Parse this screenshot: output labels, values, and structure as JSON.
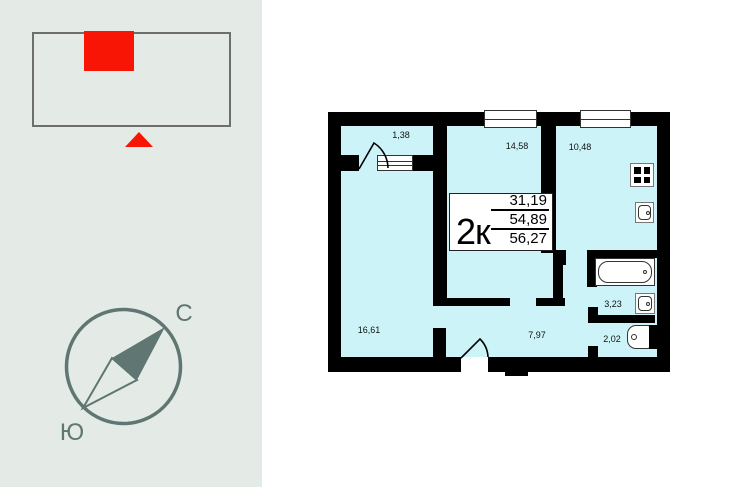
{
  "left_panel": {
    "compass": {
      "north": "С",
      "south": "Ю"
    }
  },
  "floor_plan": {
    "info_box": {
      "rooms_count": "2к",
      "living_area": "31,19",
      "usable_area": "54,89",
      "total_area": "56,27"
    },
    "rooms": [
      {
        "name": "balcony",
        "area": "1,38"
      },
      {
        "name": "room-1",
        "area": "14,58"
      },
      {
        "name": "kitchen",
        "area": "10,48"
      },
      {
        "name": "room-2",
        "area": "16,61"
      },
      {
        "name": "hallway",
        "area": "7,97"
      },
      {
        "name": "bathroom",
        "area": "3,23"
      },
      {
        "name": "toilet",
        "area": "2,02"
      }
    ]
  },
  "colors": {
    "floor_fill": "#ccf4f8",
    "wall": "#000000",
    "marker_red": "#f91505",
    "compass_green": "#5f7672",
    "panel_bg": "#e4eae6"
  }
}
